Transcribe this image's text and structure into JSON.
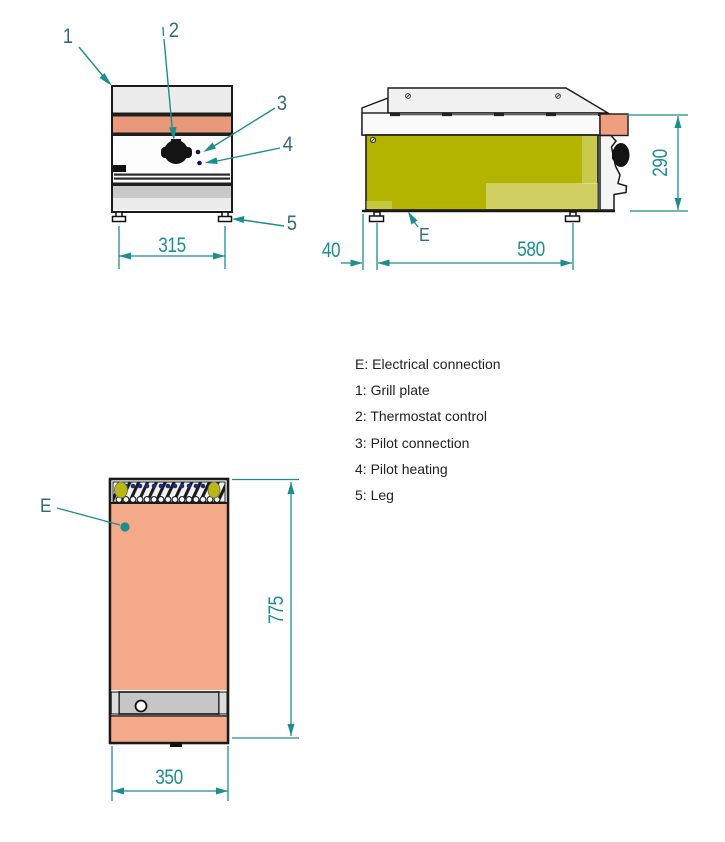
{
  "colors": {
    "teal": "#1d8e8e",
    "callout_text": "#356e6e",
    "outline": "#1a1a1a",
    "olive": "#b2b400",
    "salmon": "#f4a988",
    "salmon_band": "#e8997a",
    "salmon_block": "#ef9f7f",
    "gray_band": "#c9c9c9",
    "light_gray": "#ececec",
    "navy_dot": "#202a7a",
    "yellow_blob": "#b9b912",
    "legend_text": "#222222"
  },
  "callouts": {
    "grill_plate": "1",
    "thermostat": "2",
    "pilot_connection": "3",
    "pilot_heating": "4",
    "leg": "5",
    "electrical": "E"
  },
  "dimensions": {
    "front_leg_span": "315",
    "side_back_offset": "40",
    "side_leg_span": "580",
    "side_height": "290",
    "top_depth": "775",
    "top_width": "350"
  },
  "legend": {
    "lines": [
      "E: Electrical connection",
      "1: Grill plate",
      "2: Thermostat control",
      "3: Pilot connection",
      "4: Pilot heating",
      "5: Leg"
    ]
  }
}
